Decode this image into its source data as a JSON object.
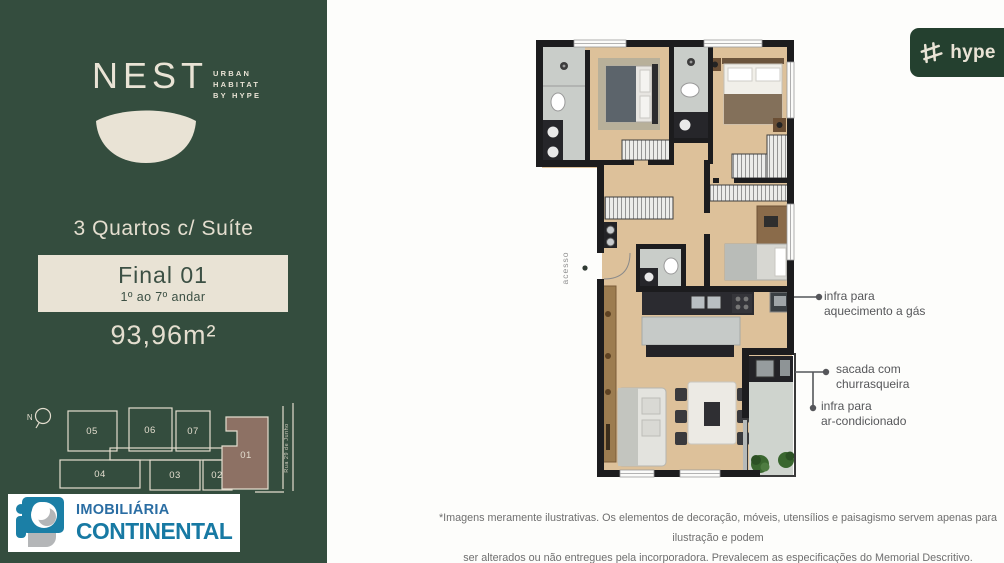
{
  "sidebar": {
    "brand": {
      "name": "NEST",
      "tagline_line1": "URBAN",
      "tagline_line2": "HABITAT",
      "tagline_line3": "BY HYPE"
    },
    "unit_type": "3 Quartos c/ Suíte",
    "badge": {
      "title": "Final 01",
      "subtitle": "1º ao 7º andar"
    },
    "area": "93,96m²",
    "keyplan": {
      "north_label": "N",
      "street_label": "Rua 29 de Junho",
      "units": [
        "05",
        "06",
        "07",
        "04",
        "03",
        "02"
      ],
      "highlighted_unit": "01"
    },
    "agency": {
      "name_line1": "IMOBILIÁRIA",
      "name_line2": "CONTINENTAL"
    }
  },
  "logos": {
    "hype_label": "hype"
  },
  "plan": {
    "access_label": "acesso",
    "annotations": [
      {
        "line1": "infra para",
        "line2": "aquecimento a gás"
      },
      {
        "line1": "sacada com",
        "line2": "churrasqueira"
      },
      {
        "line1": "infra para",
        "line2": "ar-condicionado"
      }
    ]
  },
  "footer": {
    "disclaimer_line1": "*Imagens meramente ilustrativas. Os elementos de decoração, móveis, utensílios e paisagismo servem apenas para ilustração e podem",
    "disclaimer_line2": "ser alterados ou não entregues pela incorporadora. Prevalecem as especificações do Memorial Descritivo."
  },
  "colors": {
    "sidebar_green": "#344d3e",
    "cream": "#e9e3d5",
    "hype_green": "#24402f",
    "unit01_highlight": "#8d7164",
    "agency_blue": "#1779a3",
    "wood_floor": "#ddc19a",
    "tile_grey": "#c9cdc9",
    "wall_black": "#1c1c1e"
  }
}
